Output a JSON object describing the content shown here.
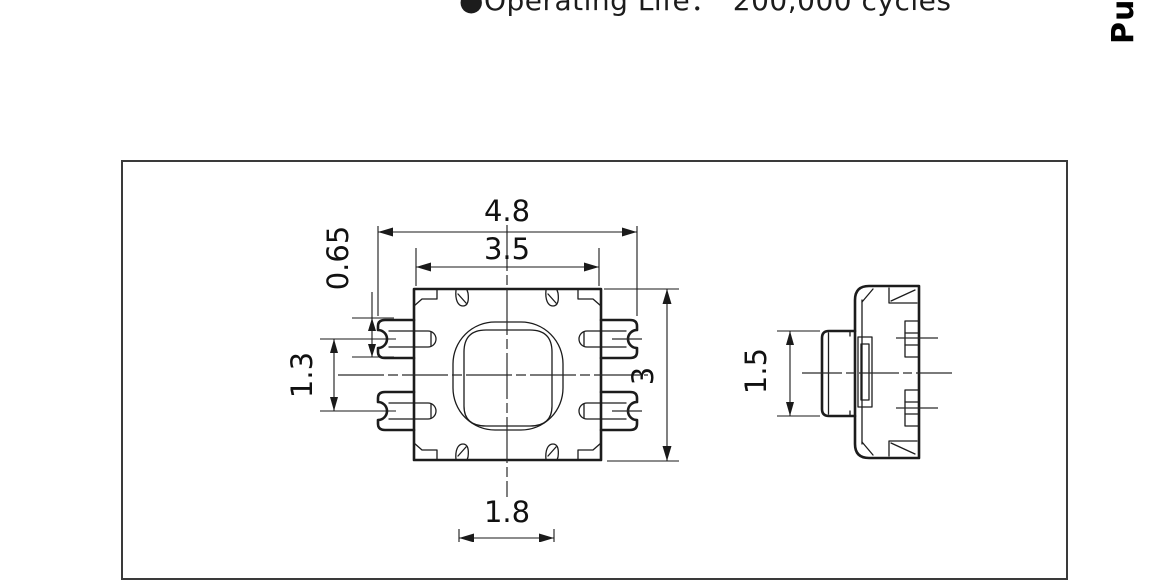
{
  "spec_line": {
    "bullet": "●",
    "label": "Operating Life：",
    "value": "200,000 cycles"
  },
  "side_tab": {
    "label": "Push"
  },
  "drawing": {
    "body_fill": "#e7edf7",
    "outline_color": "#1c1c1c",
    "dim_color": "#1a1a1a",
    "frame_color": "#3a3a3a",
    "dimensions": {
      "overall_width": "4.8",
      "cover_width": "3.5",
      "terminal_width": "0.65",
      "terminal_pitch": "1.3",
      "body_depth": "3",
      "notch_pitch": "1.8",
      "button_height": "1.5"
    }
  }
}
